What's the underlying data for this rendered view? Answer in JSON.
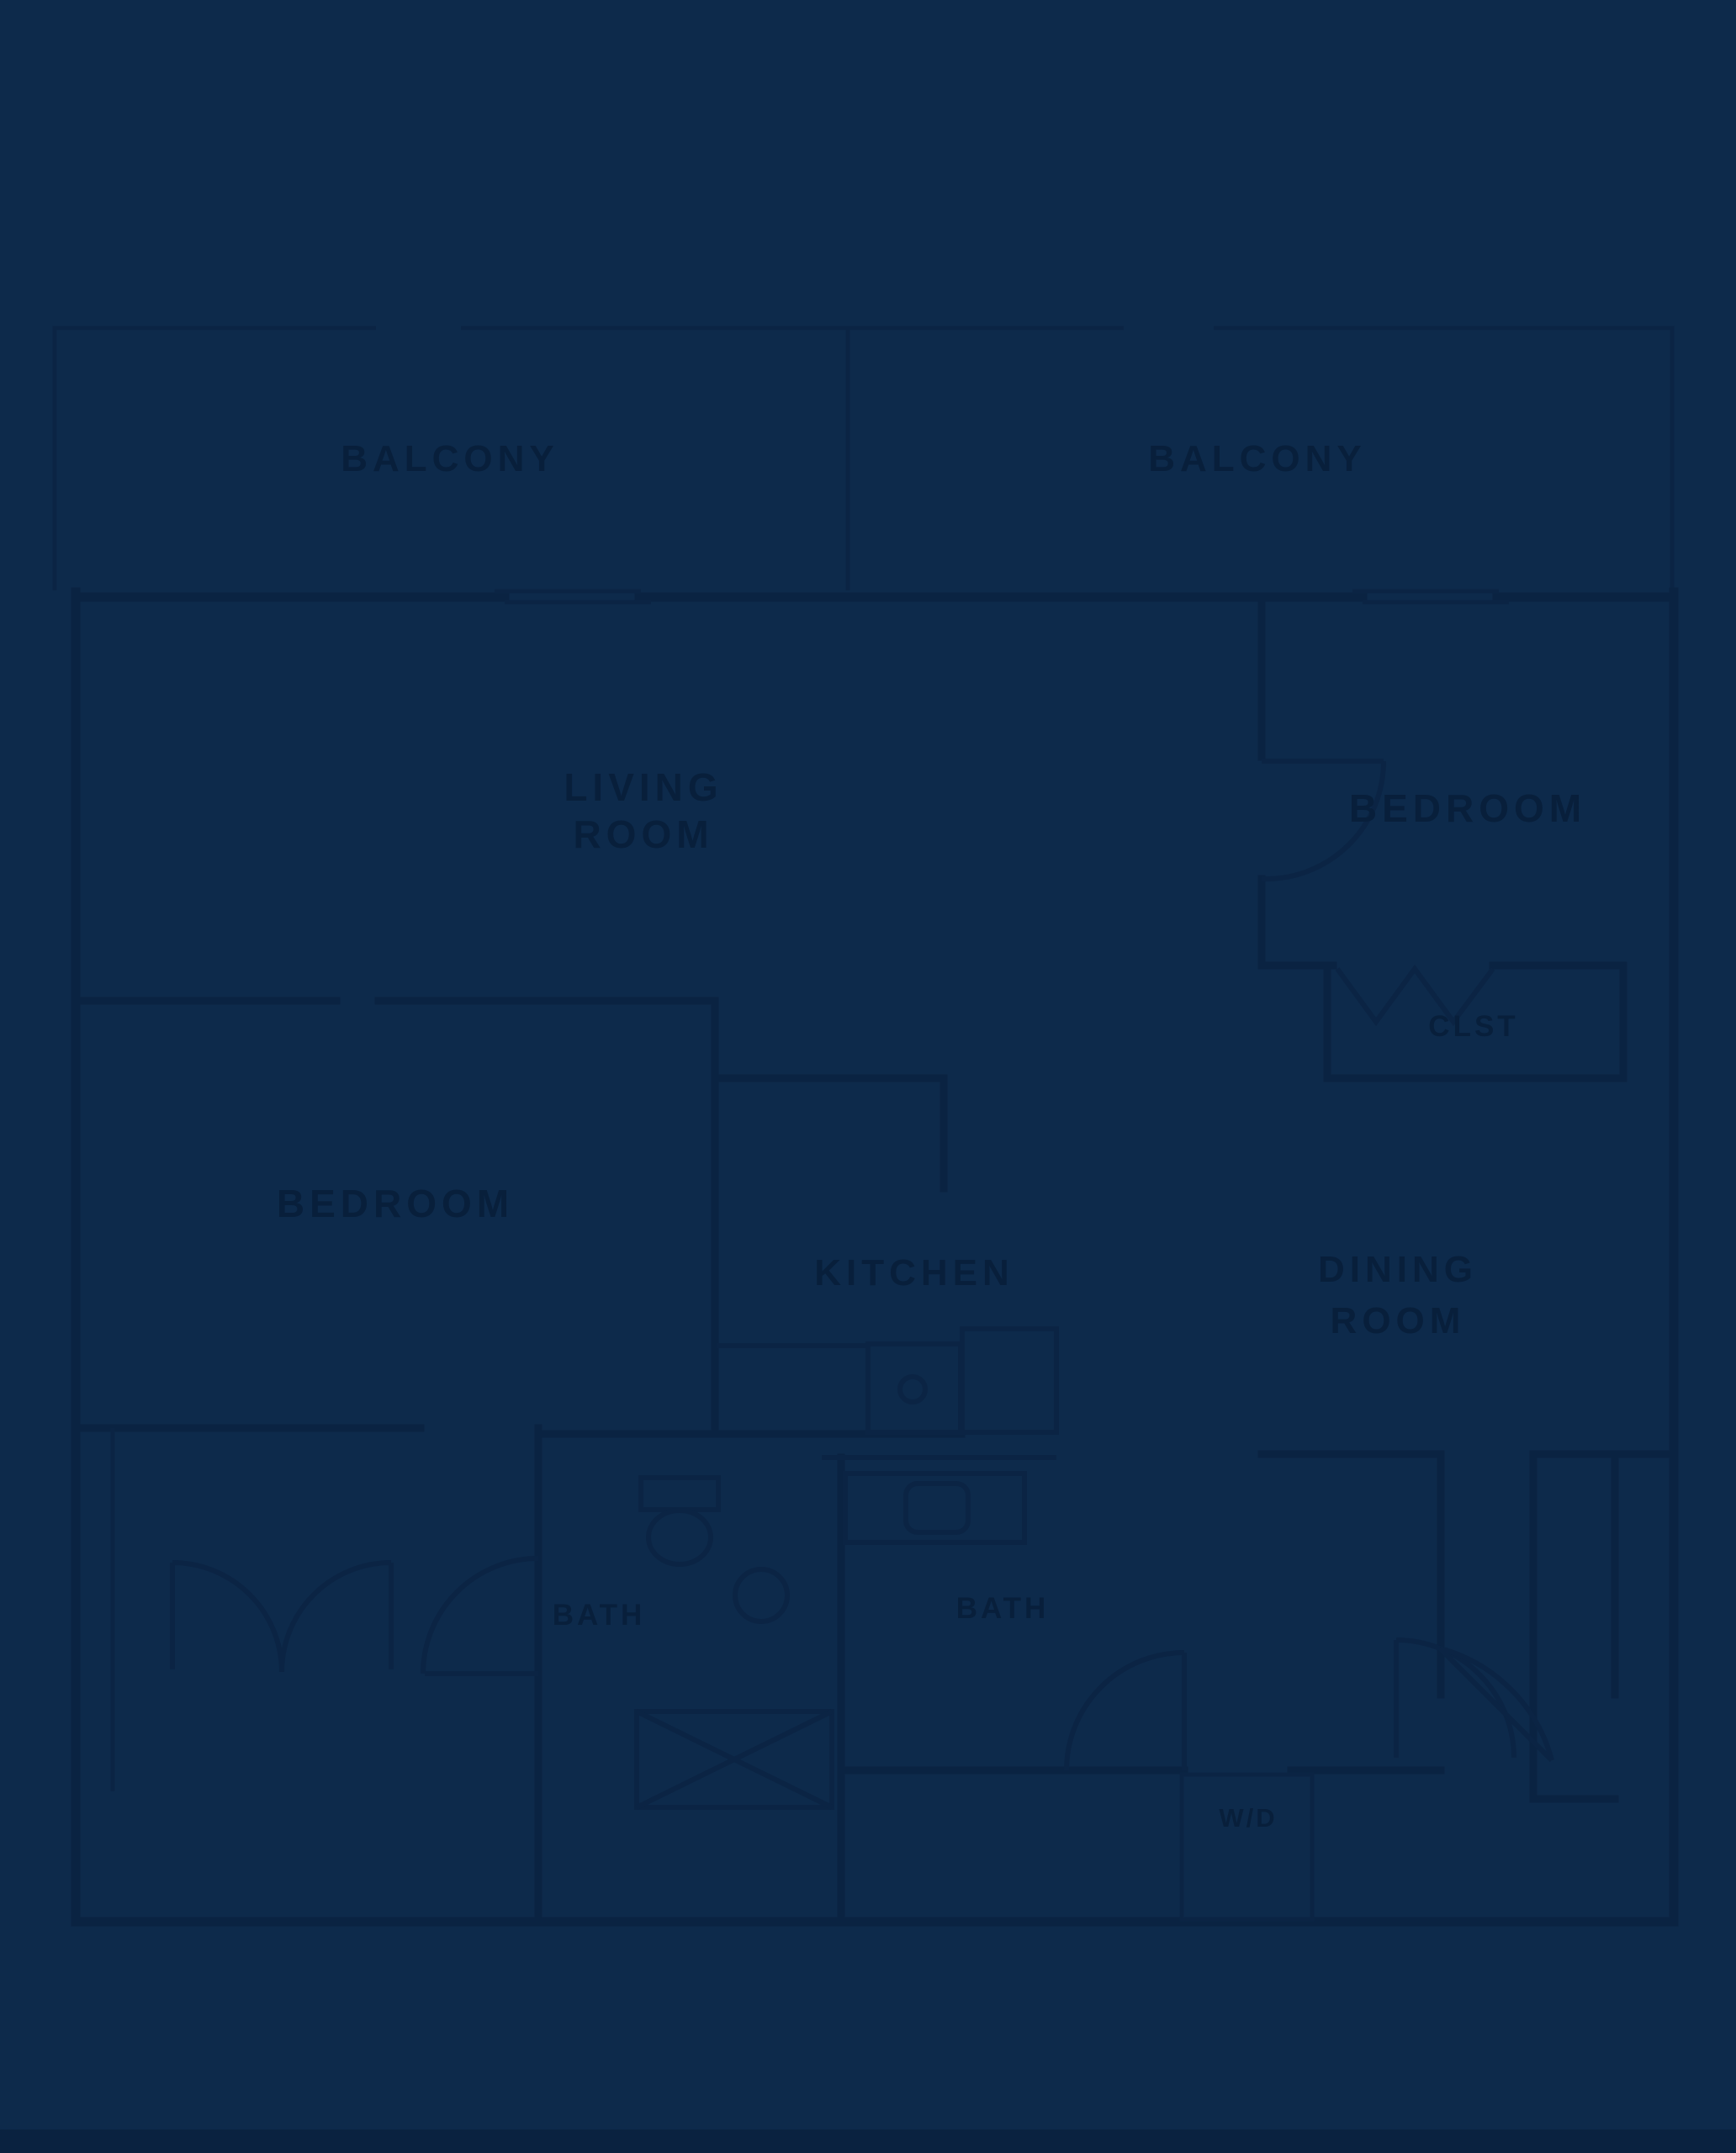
{
  "palette": {
    "background": "#0d2a4b",
    "wall_line": "#0a2342",
    "fixture_line": "#0b2444",
    "label_text": "#081f3b"
  },
  "plan": {
    "balcony_left": {
      "label": "BALCONY"
    },
    "balcony_right": {
      "label": "BALCONY"
    },
    "living_room": {
      "line1": "LIVING",
      "line2": "ROOM"
    },
    "bedroom_right": {
      "label": "BEDROOM"
    },
    "closet_right": {
      "label": "CLST"
    },
    "bedroom_left": {
      "label": "BEDROOM"
    },
    "kitchen": {
      "label": "KITCHEN"
    },
    "dining_room": {
      "line1": "DINING",
      "line2": "ROOM"
    },
    "bath_left": {
      "label": "BATH"
    },
    "bath_right": {
      "label": "BATH"
    },
    "laundry": {
      "label": "W/D"
    }
  }
}
